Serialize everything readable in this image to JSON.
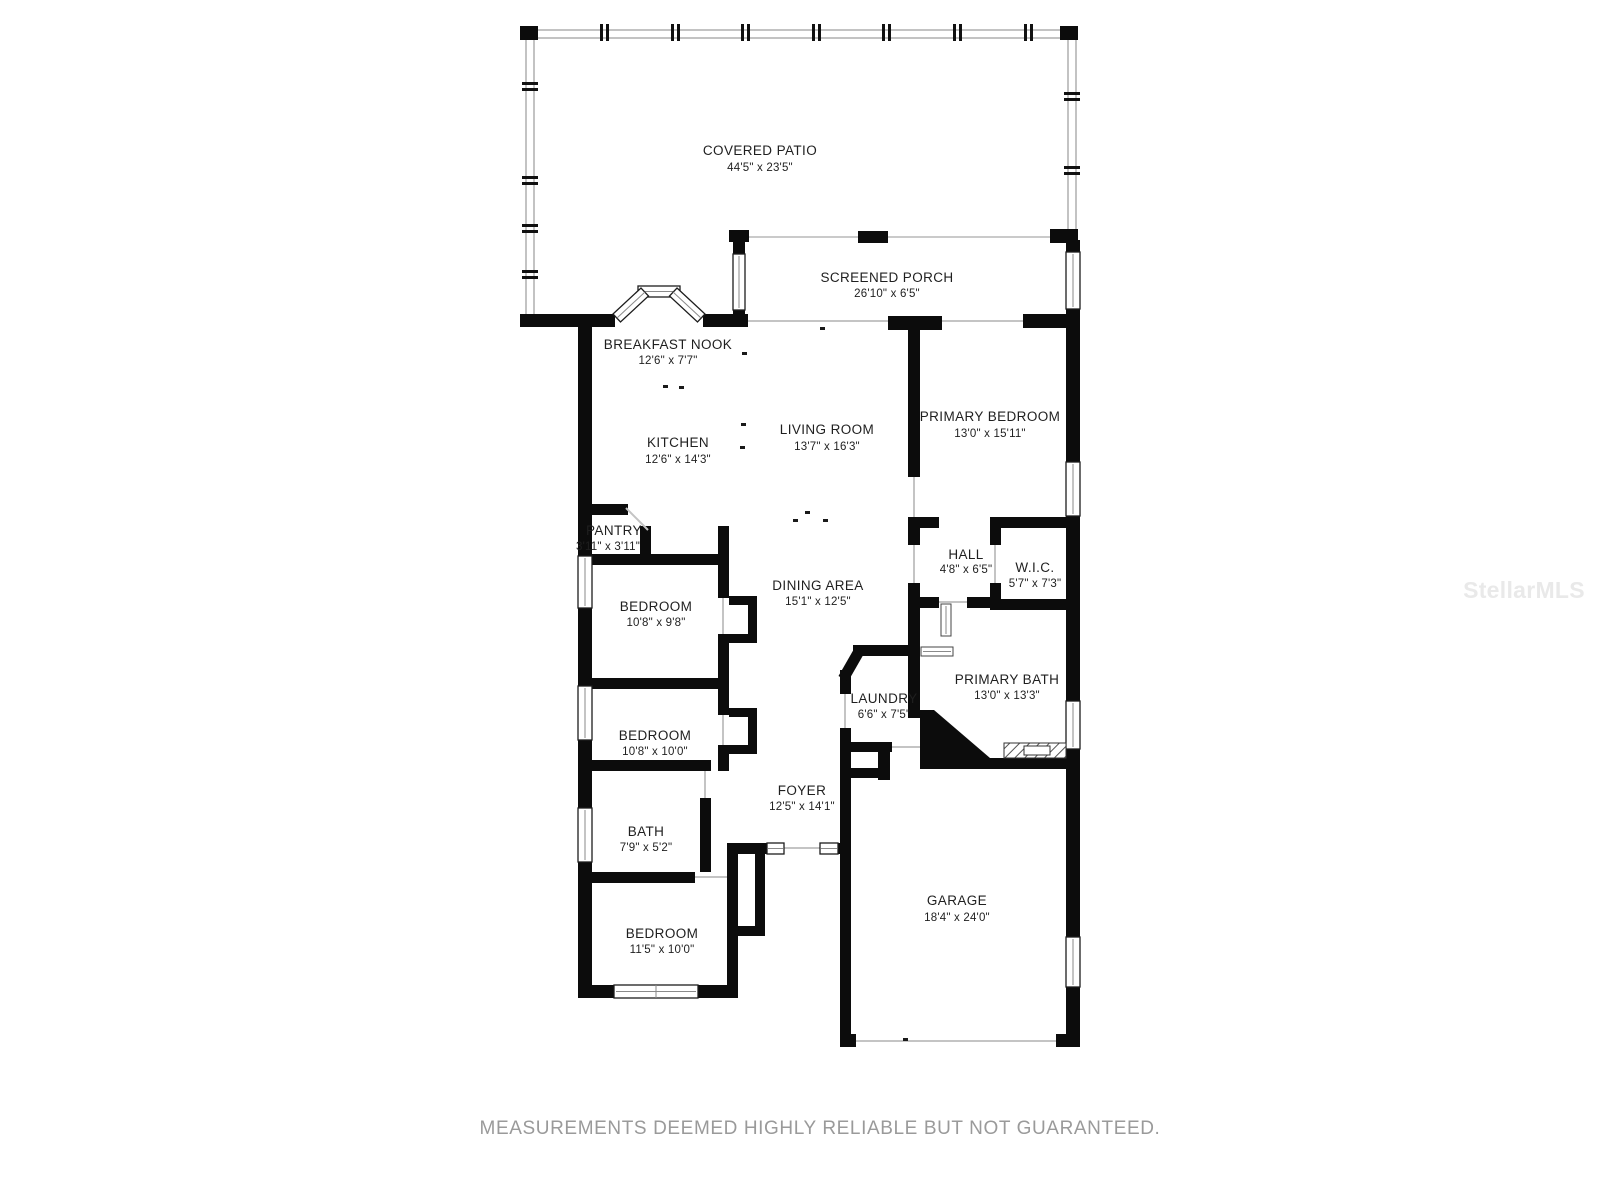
{
  "watermark": "StellarMLS",
  "disclaimer": "MEASUREMENTS DEEMED HIGHLY RELIABLE BUT NOT GUARANTEED.",
  "colors": {
    "wall": "#0c0c0c",
    "label": "#1f1f1f",
    "disclaimer": "#9a9a9a",
    "watermark": "#e9e9e9",
    "thin_line": "#c4c4c4",
    "screen_wall_outline": "#9b9b9b"
  },
  "rooms": {
    "covered_patio": {
      "name": "COVERED PATIO",
      "dims": "44'5\" x 23'5\""
    },
    "screened_porch": {
      "name": "SCREENED PORCH",
      "dims": "26'10\" x 6'5\""
    },
    "breakfast_nook": {
      "name": "BREAKFAST NOOK",
      "dims": "12'6\" x 7'7\""
    },
    "kitchen": {
      "name": "KITCHEN",
      "dims": "12'6\" x 14'3\""
    },
    "living_room": {
      "name": "LIVING ROOM",
      "dims": "13'7\" x 16'3\""
    },
    "primary_bedroom": {
      "name": "PRIMARY BEDROOM",
      "dims": "13'0\" x 15'11\""
    },
    "pantry": {
      "name": "PANTRY",
      "dims": "3'11\" x 3'11\""
    },
    "hall": {
      "name": "HALL",
      "dims": "4'8\" x 6'5\""
    },
    "wic": {
      "name": "W.I.C.",
      "dims": "5'7\" x 7'3\""
    },
    "dining_area": {
      "name": "DINING AREA",
      "dims": "15'1\" x 12'5\""
    },
    "bedroom_1": {
      "name": "BEDROOM",
      "dims": "10'8\" x 9'8\""
    },
    "primary_bath": {
      "name": "PRIMARY BATH",
      "dims": "13'0\" x 13'3\""
    },
    "laundry": {
      "name": "LAUNDRY",
      "dims": "6'6\" x 7'5\""
    },
    "bedroom_2": {
      "name": "BEDROOM",
      "dims": "10'8\" x 10'0\""
    },
    "foyer": {
      "name": "FOYER",
      "dims": "12'5\" x 14'1\""
    },
    "bath": {
      "name": "BATH",
      "dims": "7'9\" x 5'2\""
    },
    "bedroom_3": {
      "name": "BEDROOM",
      "dims": "11'5\" x 10'0\""
    },
    "garage": {
      "name": "GARAGE",
      "dims": "18'4\" x 24'0\""
    }
  }
}
